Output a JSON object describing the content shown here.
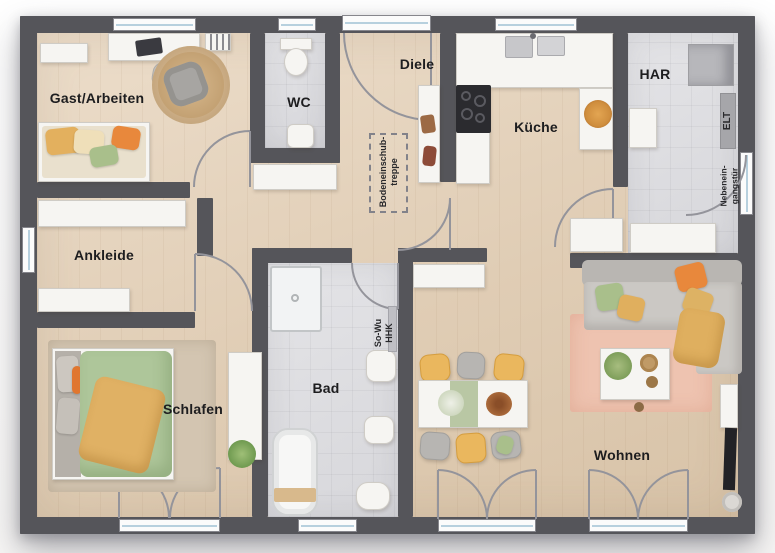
{
  "plan": {
    "rooms": [
      {
        "id": "gast-arbeiten",
        "label": "Gast/Arbeiten"
      },
      {
        "id": "wc",
        "label": "WC"
      },
      {
        "id": "diele",
        "label": "Diele"
      },
      {
        "id": "kueche",
        "label": "Küche"
      },
      {
        "id": "har",
        "label": "HAR"
      },
      {
        "id": "ankleide",
        "label": "Ankleide"
      },
      {
        "id": "schlafen",
        "label": "Schlafen"
      },
      {
        "id": "bad",
        "label": "Bad"
      },
      {
        "id": "wohnen",
        "label": "Wohnen"
      }
    ],
    "annotations": {
      "attic_stairs_lines": [
        "Bodeneinschub-",
        "treppe"
      ],
      "heating_lines": [
        "So-Wu",
        "HHK"
      ],
      "electrical_label": "ELT",
      "side_entrance_lines": [
        "Nebenein-",
        "gangstür"
      ]
    },
    "colors": {
      "wall": "#55555a",
      "wood_floor": "#e0cdb5",
      "tile_floor": "#dcdce0",
      "accent_orange": "#e8883c",
      "accent_mustard": "#e3b05e",
      "accent_green": "#a9bf8b",
      "rug_pink": "#eec3b0"
    }
  }
}
